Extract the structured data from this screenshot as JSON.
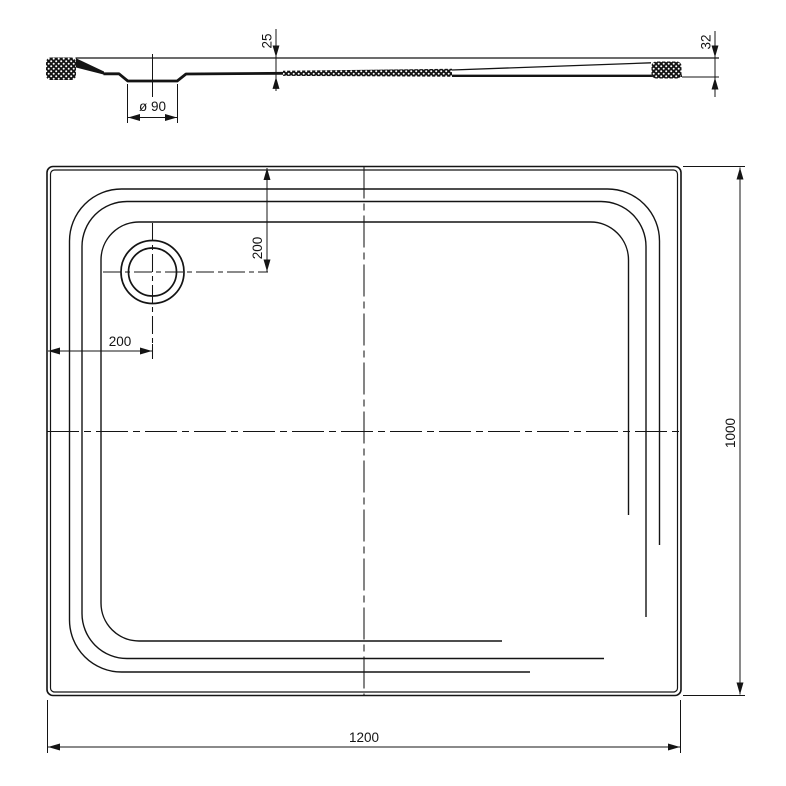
{
  "title": "shower-tray-technical-drawing",
  "side_view": {
    "depth_dim": "25",
    "edge_height_dim": "32",
    "drain_diameter_dim": "ø 90"
  },
  "plan_view": {
    "drain_offset_top_dim": "200",
    "drain_offset_left_dim": "200",
    "width_dim": "1200",
    "depth_dim": "1000"
  },
  "colors": {
    "ink": "#141414",
    "background": "#ffffff"
  }
}
